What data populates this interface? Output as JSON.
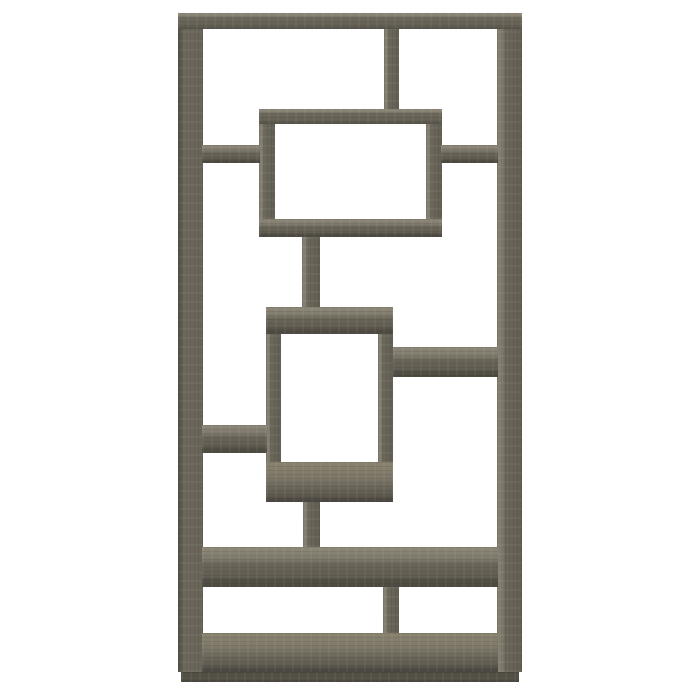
{
  "image": {
    "type": "product-photo",
    "description": "Tall open geometric bookcase with interlocking rectangular shelves in a weathered grey woodgrain finish, front view on a plain white background",
    "background_color": "#ffffff"
  },
  "palette": {
    "wood_top_surface": "#8e8879",
    "wood_front_face": "#676357",
    "wood_side_face": "#847e70",
    "wood_dark_edge": "#4c4941",
    "base_strip": "#57544a",
    "background": "#ffffff"
  },
  "bookcase": {
    "canvas": {
      "width": 700,
      "height": 700
    },
    "bounds": {
      "x": 178,
      "y": 13,
      "width": 344,
      "height": 669
    },
    "parts": [
      {
        "id": "left-side-post",
        "kind": "post",
        "x": 178,
        "y": 13,
        "w": 25,
        "h": 659
      },
      {
        "id": "right-side-post",
        "kind": "post-light",
        "x": 497,
        "y": 13,
        "w": 25,
        "h": 659
      },
      {
        "id": "top-center-divider",
        "kind": "post-light",
        "x": 384,
        "y": 28,
        "w": 15,
        "h": 82
      },
      {
        "id": "upper-box-left-side",
        "kind": "post-light",
        "x": 259,
        "y": 109,
        "w": 16,
        "h": 128
      },
      {
        "id": "upper-box-right-side",
        "kind": "post-light",
        "x": 426,
        "y": 109,
        "w": 16,
        "h": 128
      },
      {
        "id": "upper-connector-post",
        "kind": "post-light",
        "x": 302,
        "y": 237,
        "w": 18,
        "h": 70
      },
      {
        "id": "middle-box-left-side",
        "kind": "post-light",
        "x": 266,
        "y": 308,
        "w": 15,
        "h": 194
      },
      {
        "id": "middle-box-right-side",
        "kind": "post-light",
        "x": 378,
        "y": 308,
        "w": 15,
        "h": 194
      },
      {
        "id": "lower-connector-post",
        "kind": "post-light",
        "x": 303,
        "y": 500,
        "w": 17,
        "h": 47
      },
      {
        "id": "bottom-center-divider",
        "kind": "post-light",
        "x": 383,
        "y": 587,
        "w": 16,
        "h": 48
      },
      {
        "id": "top-board",
        "kind": "board-top",
        "x": 178,
        "y": 13,
        "w": 344,
        "h": 16
      },
      {
        "id": "upper-box-top-board",
        "kind": "board-top",
        "x": 259,
        "y": 109,
        "w": 183,
        "h": 15
      },
      {
        "id": "upper-box-bottom-board",
        "kind": "board",
        "x": 259,
        "y": 219,
        "w": 183,
        "h": 18
      },
      {
        "id": "upper-left-stub-shelf",
        "kind": "board",
        "x": 202,
        "y": 145,
        "w": 58,
        "h": 18
      },
      {
        "id": "upper-right-stub-shelf",
        "kind": "board",
        "x": 441,
        "y": 145,
        "w": 57,
        "h": 18
      },
      {
        "id": "middle-box-top-board",
        "kind": "board",
        "x": 266,
        "y": 307,
        "w": 127,
        "h": 27
      },
      {
        "id": "middle-box-bottom-board",
        "kind": "board-floor",
        "x": 266,
        "y": 462,
        "w": 127,
        "h": 40
      },
      {
        "id": "middle-right-shelf",
        "kind": "board",
        "x": 393,
        "y": 347,
        "w": 105,
        "h": 30
      },
      {
        "id": "middle-left-shelf",
        "kind": "board",
        "x": 202,
        "y": 425,
        "w": 65,
        "h": 28
      },
      {
        "id": "long-middle-shelf",
        "kind": "board",
        "x": 202,
        "y": 547,
        "w": 296,
        "h": 40
      },
      {
        "id": "bottom-floor-board",
        "kind": "board-floor",
        "x": 202,
        "y": 633,
        "w": 296,
        "h": 39
      },
      {
        "id": "base-strip",
        "kind": "plinth",
        "x": 181,
        "y": 672,
        "w": 338,
        "h": 10
      }
    ]
  }
}
